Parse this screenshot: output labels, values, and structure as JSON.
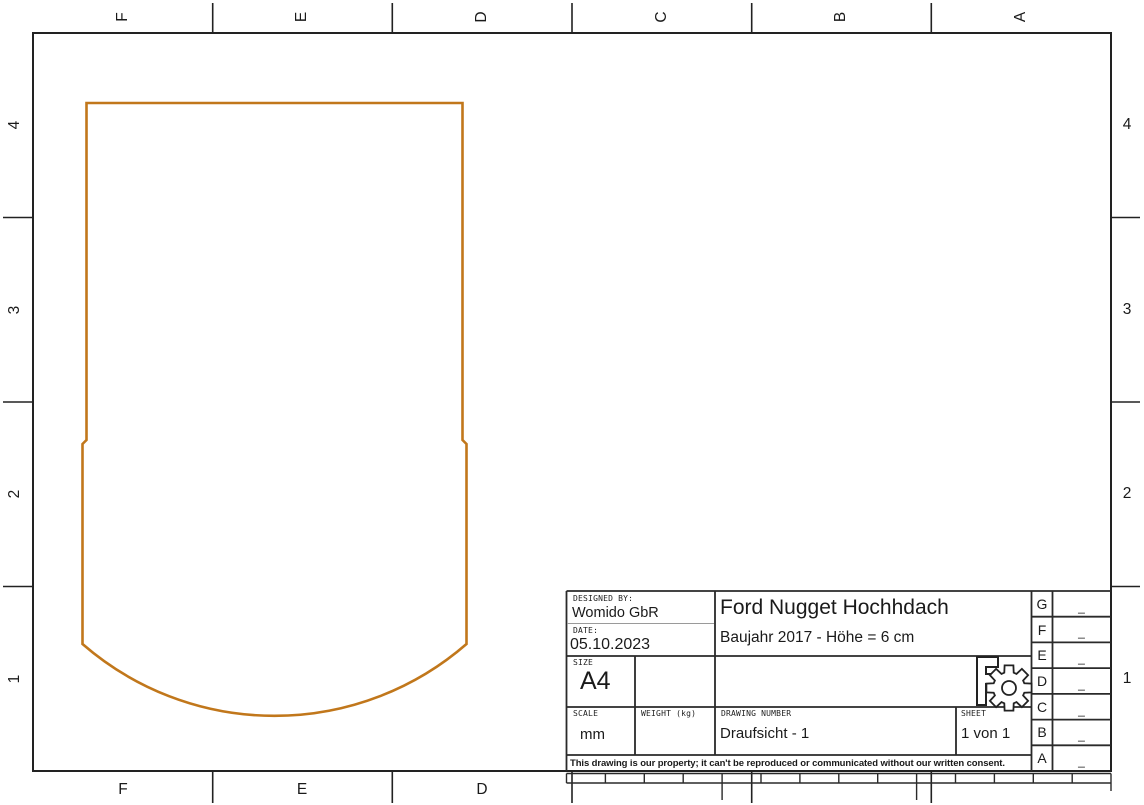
{
  "zones": {
    "top_letters": [
      "F",
      "E",
      "D",
      "C",
      "B",
      "A"
    ],
    "bottom_letters": [
      "F",
      "E",
      "D"
    ],
    "left_numbers": [
      "4",
      "3",
      "2",
      "1"
    ],
    "right_numbers": [
      "4",
      "3",
      "2",
      "1"
    ]
  },
  "title_block": {
    "designed_by_label": "DESIGNED BY:",
    "designed_by": "Womido GbR",
    "date_label": "DATE:",
    "date": "05.10.2023",
    "size_label": "SIZE",
    "size": "A4",
    "scale_label": "SCALE",
    "scale": "mm",
    "weight_label": "WEIGHT (kg)",
    "drawing_number_label": "DRAWING NUMBER",
    "drawing_number": "Draufsicht - 1",
    "sheet_label": "SHEET",
    "sheet": "1 von 1",
    "title": "Ford Nugget Hochhdach",
    "subtitle": "Baujahr 2017 - Höhe = 6 cm",
    "disclaimer": "This drawing is our property; it can't be reproduced or communicated without our written consent.",
    "revision_letters": [
      "G",
      "F",
      "E",
      "D",
      "C",
      "B",
      "A"
    ],
    "revision_dash": "_",
    "logo_name": "freecad-gear-logo"
  },
  "drawing": {
    "shape_name": "roof-outline-top-view",
    "stroke_color": "#C1771B",
    "line_color": "#222222"
  }
}
